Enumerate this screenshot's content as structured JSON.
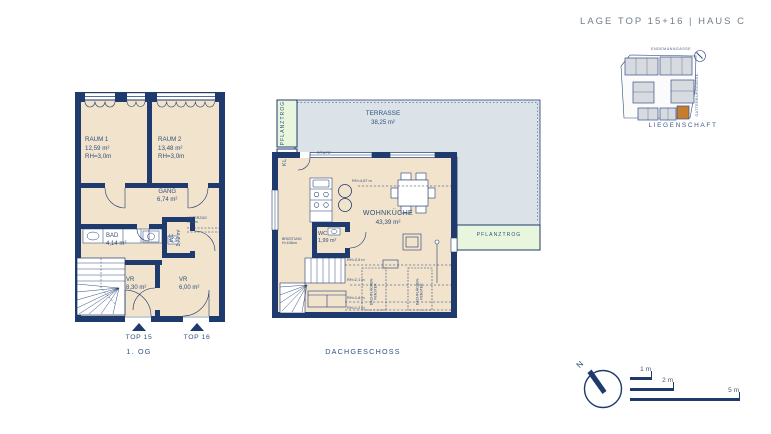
{
  "header": {
    "title": "LAGE TOP 15+16  |  HAUS C"
  },
  "site_plan": {
    "street_top": "ENDEMANNGASSE",
    "street_right": "GATTERBURGGASSE",
    "caption": "LIEGENSCHAFT"
  },
  "plan_og": {
    "caption": "1. OG",
    "raum1": {
      "name": "RAUM 1",
      "area": "12,59 m²",
      "rh": "RH=3,0m"
    },
    "raum2": {
      "name": "RAUM 2",
      "area": "13,48 m²",
      "rh": "RH=3,0m"
    },
    "gang": {
      "name": "GANG",
      "area": "6,74 m²"
    },
    "bad": {
      "name": "BAD",
      "area": "4,14 m²"
    },
    "wc": {
      "name": "WC",
      "area": "1,72 m²"
    },
    "vr1": {
      "name": "VR",
      "area": "8,30 m²"
    },
    "vr2": {
      "name": "VR",
      "area": "6,00 m²"
    },
    "unterzug": {
      "line1": "UNTERZUG",
      "line2": "±30cm"
    },
    "top15": "TOP 15",
    "top16": "TOP 16"
  },
  "plan_dg": {
    "caption": "DACHGESCHOSS",
    "terrasse": {
      "name": "TERRASSE",
      "area": "38,25 m²"
    },
    "wohnkueche": {
      "name": "WOHNKÜCHE",
      "area": "43,39 m²"
    },
    "wc": {
      "name": "WC",
      "area": "1,99 m²"
    },
    "pflanztrog_left": "PFLANZTROG",
    "pflanztrog_right": "PFLANZTROG",
    "kl": "KL",
    "stufe": "STUFE",
    "bruestung": {
      "line1": "BRÜSTUNG",
      "line2": "H=108cm"
    },
    "rh_ceiling": "RH=4,57 m",
    "rh1": "RH=2,5 m",
    "rh2": "RH=2,1 m",
    "rh3": "RH=1,6 m",
    "rh4": "RH=1,2 m",
    "roof_window": {
      "line1": "DACHFLÄCHEN-",
      "line2": "FENSTER"
    }
  },
  "legend": {
    "north": "N",
    "scale_1": "1 m",
    "scale_2": "2 m",
    "scale_5": "5 m"
  },
  "colors": {
    "navy": "#1f3a6d",
    "room_beige": "#f2e3cd",
    "terrace_gray": "#dbe2e8",
    "planter_green": "#e8f6de",
    "highlight_orange": "#c87c2d"
  }
}
